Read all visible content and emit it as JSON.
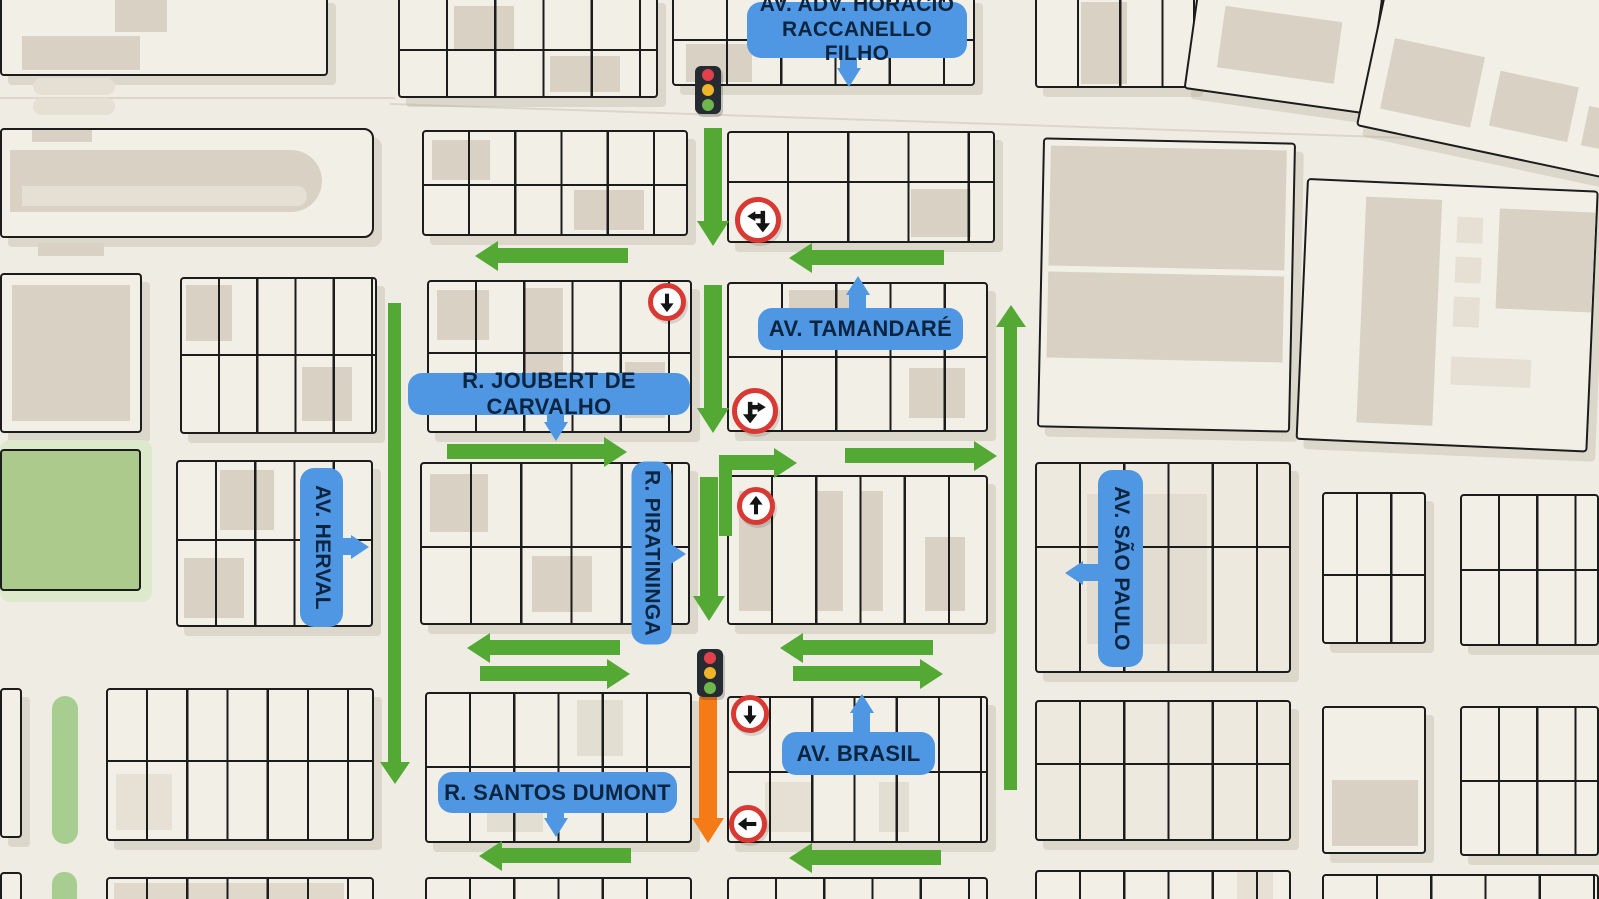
{
  "labels": {
    "horacio_line1": "AV. ADV. HORÁCIO",
    "horacio_line2": "RACCANELLO FILHO",
    "tamandare": "AV. TAMANDARÉ",
    "joubert": "R. JOUBERT DE CARVALHO",
    "piratininga": "R. PIRATININGA",
    "herval": "AV. HERVAL",
    "sao_paulo": "AV. SÃO PAULO",
    "santos_dumont": "R. SANTOS DUMONT",
    "brasil": "AV. BRASIL"
  },
  "label_pointers": {
    "horacio": "down",
    "tamandare": "up",
    "joubert": "down",
    "piratininga": "right",
    "herval": "right",
    "sao_paulo": "left",
    "santos_dumont": "down",
    "brasil": "up"
  },
  "icons": {
    "traffic_lights": [
      "traffic-light-icon (top of center road)",
      "traffic-light-icon (center road at lower intersection)"
    ],
    "signs": [
      "sign-straight-down-or-left-icon",
      "sign-one-way-down-icon",
      "sign-straight-down-or-right-icon",
      "sign-one-way-up-icon",
      "sign-one-way-down-icon",
      "sign-one-way-left-icon"
    ],
    "flow_arrows": [
      "green down x3 on center road",
      "green long down on Av. Herval road",
      "green long up on Av. São Paulo road",
      "green left+left on Av. Tamandaré street",
      "green right x2 and up-then-right on R. Joubert de Carvalho street",
      "green left/right pairs on mid street",
      "green left x2 on R. Santos Dumont street",
      "orange down on center road between intersections"
    ]
  },
  "colors": {
    "bg": "#efece4",
    "block": "#f2efe7",
    "line": "#1c1c1c",
    "building": "#d9d2c4",
    "building2": "#e6e0d4",
    "green": "#53a933",
    "orange": "#f57b17",
    "blue": "#4f97e3",
    "label-text": "#0b2440",
    "sign-red": "#d83a33",
    "park": "#abca8c",
    "park-glow": "#dce9cb",
    "median": "#a8cd90",
    "light-red": "#e2414b",
    "light-yellow": "#f0b429",
    "light-green": "#6db74d",
    "tl-body": "#262a31"
  }
}
